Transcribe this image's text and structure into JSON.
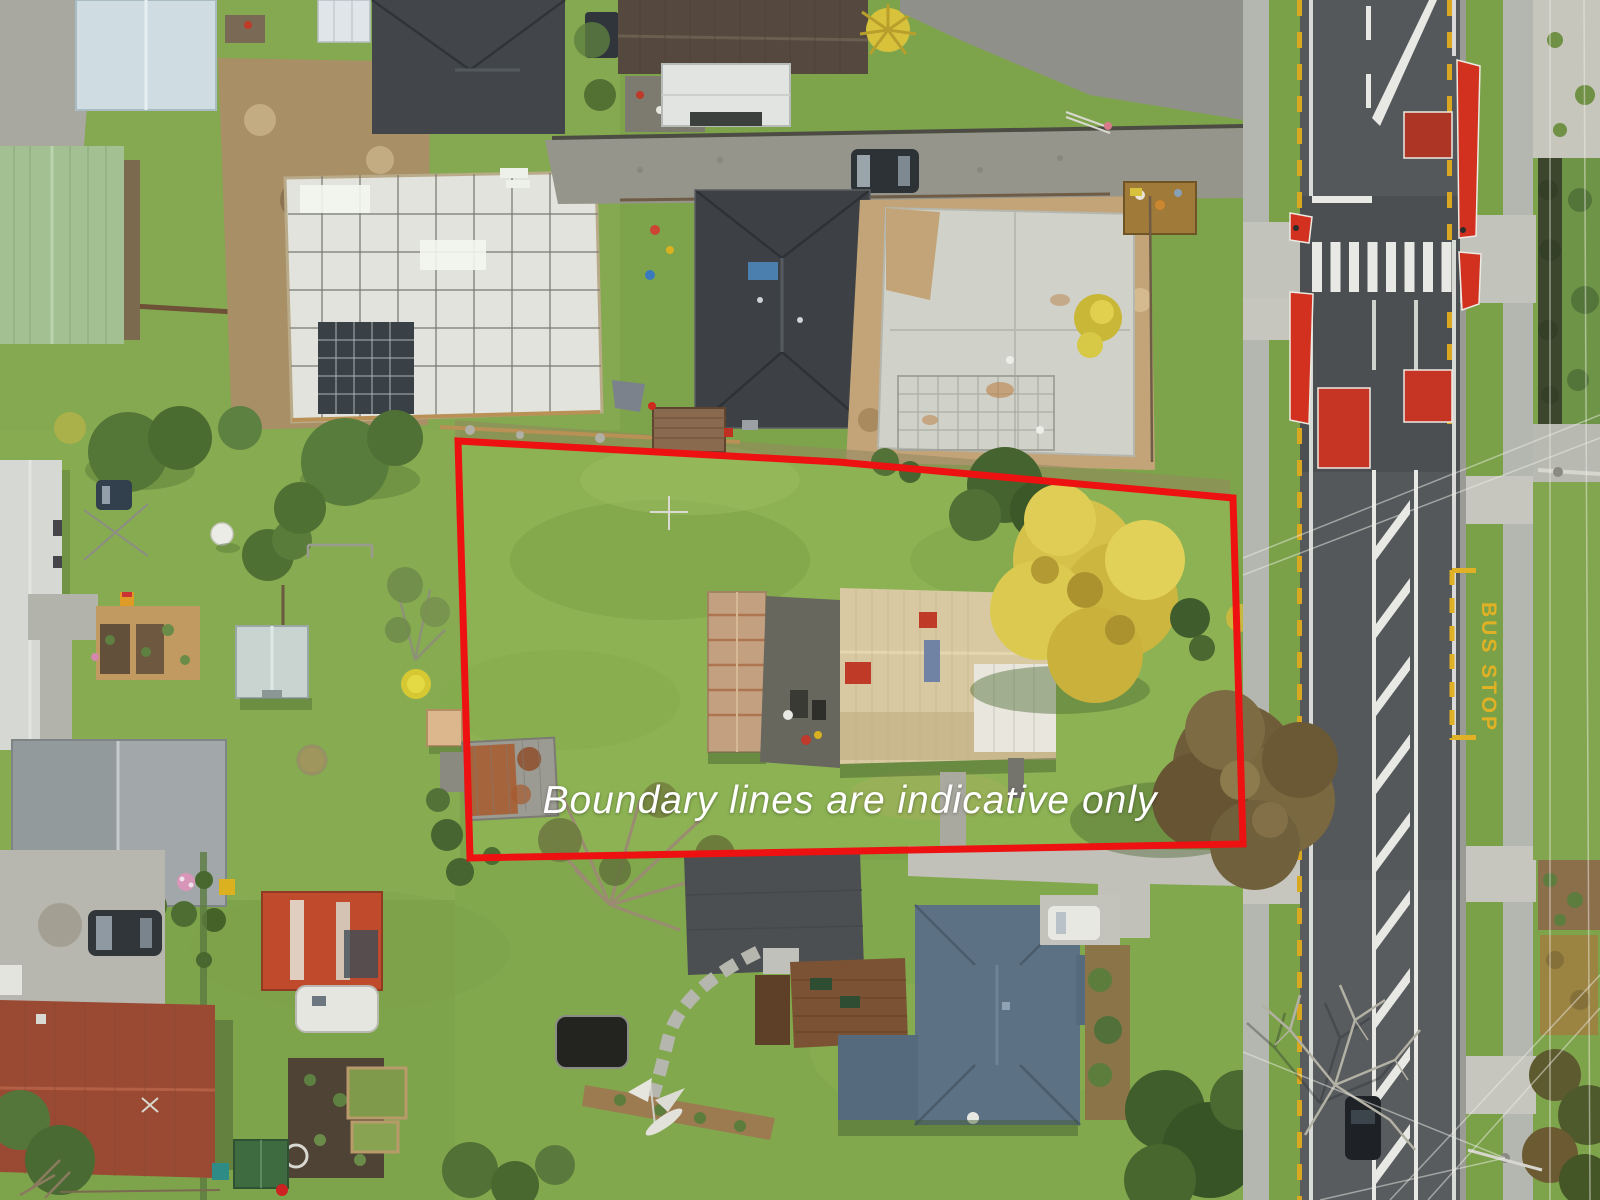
{
  "overlay": {
    "disclaimer": "Boundary lines are indicative only"
  },
  "road_markings": {
    "bus_stop_label": "BUS STOP"
  },
  "colors": {
    "boundary_red": "#ee1111",
    "disclaimer_white": "#ffffff",
    "bus_stop_yellow": "#e0b124",
    "marking_yellow": "#d9a820",
    "marking_white": "#e8e9e4",
    "road_asphalt": "#54585b",
    "grass_green": "#7ea44b",
    "golden_tree": "#d7c24a",
    "subject_roof_beige": "#d9c9a2",
    "traffic_red_patch": "#cf3322"
  }
}
